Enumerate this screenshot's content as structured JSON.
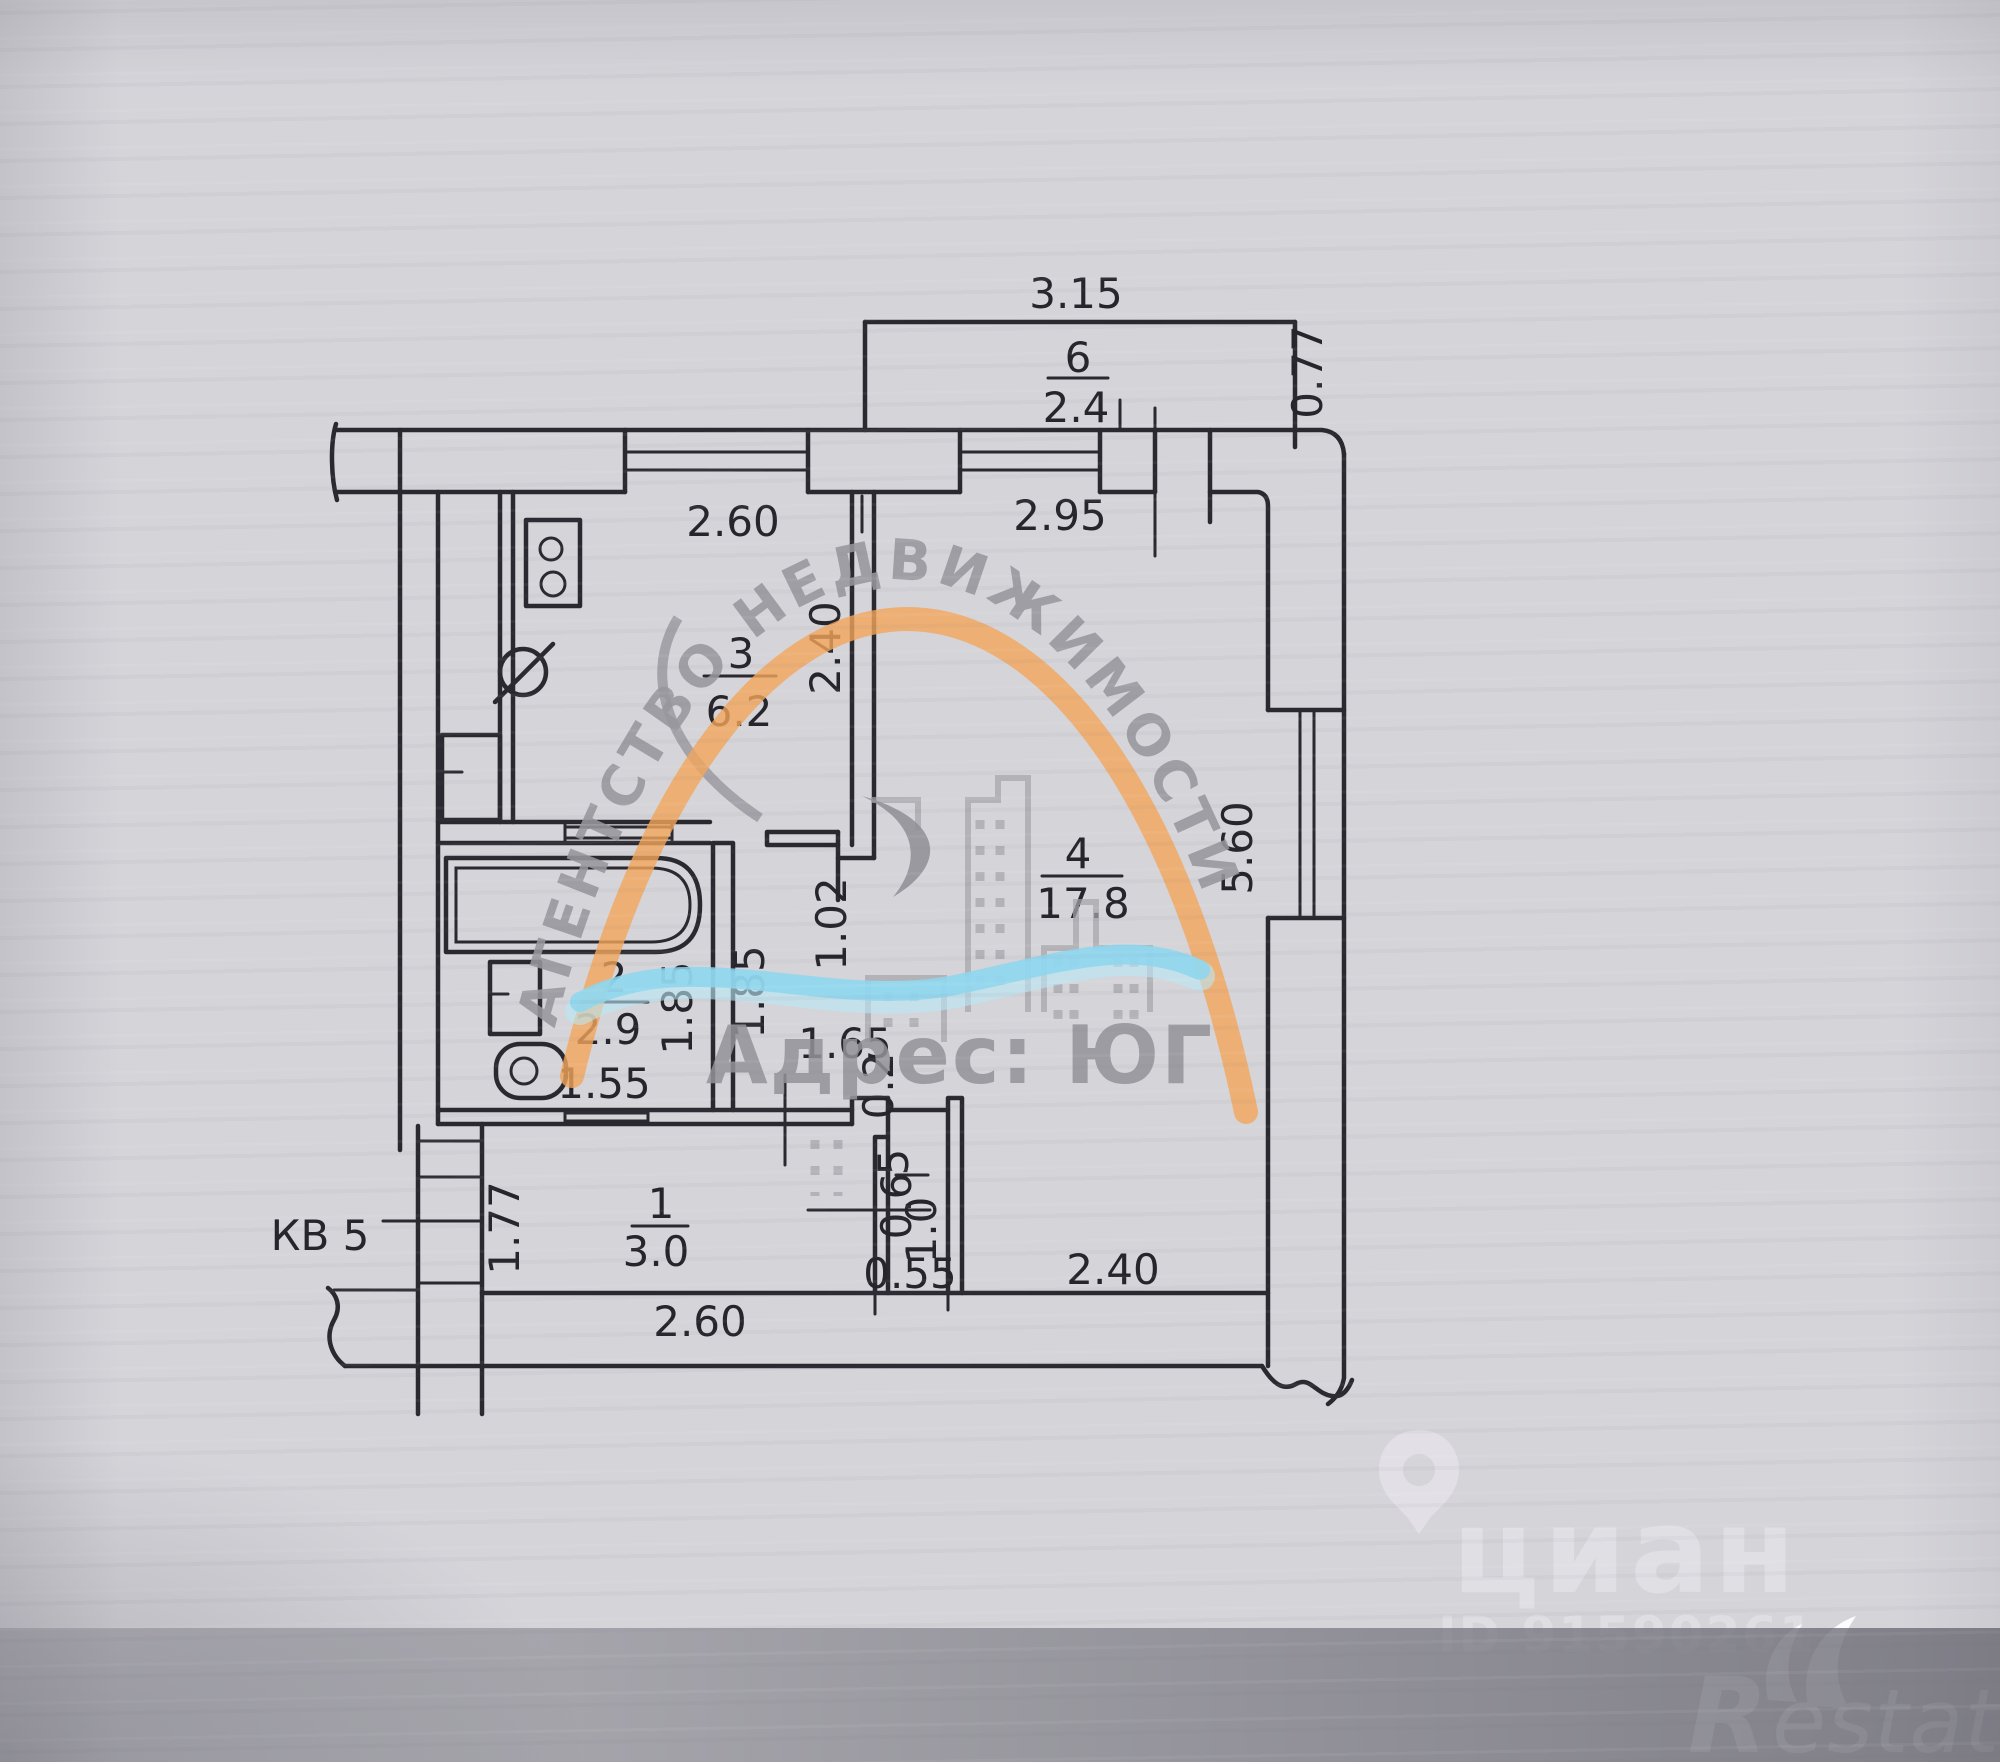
{
  "plan": {
    "apartment_label": "КВ 5",
    "rooms": {
      "kitchen": {
        "num": "3",
        "area": "6.2"
      },
      "bathroom": {
        "num": "2",
        "area": "2.9"
      },
      "hall": {
        "num": "1",
        "area": "3.0"
      },
      "living_room": {
        "num": "4",
        "area": "17.8"
      },
      "closet": {
        "num": "5",
        "area": "0.6"
      },
      "balcony": {
        "num": "6",
        "area": "2.4"
      }
    },
    "dimensions": {
      "balcony_width": "3.15",
      "balcony_depth": "0.77",
      "kitchen_width": "2.60",
      "kitchen_depth": "2.40",
      "living_top_width": "2.95",
      "living_height": "5.60",
      "living_bottom_width": "2.40",
      "living_door": "1.02",
      "bath_depth_left": "1.85",
      "bath_depth_right": "1.85",
      "bath_width": "1.55",
      "hall_passage": "1.65",
      "hall_width": "2.60",
      "closet_notch": "0.2",
      "closet_depth": "1.0",
      "closet_width": "0.55",
      "entry_width": "1.77"
    }
  },
  "watermarks": {
    "agency_arc": "АГЕНТСТВО НЕДВИЖИМОСТИ",
    "agency_name": "Адрес: ЮГ",
    "cian": {
      "logo": "циан",
      "listing_id": "ID 91590261"
    },
    "restate": {
      "logo_r": "R",
      "logo_rest": "estate"
    }
  },
  "colors": {
    "paper": "#d5d4d9",
    "ink": "#2a2930",
    "watermark_gray": "#98979d",
    "watermark_orange": "#f2a55a",
    "watermark_blue": "#8dd6ee",
    "watermark_white": "#eceaf0"
  }
}
